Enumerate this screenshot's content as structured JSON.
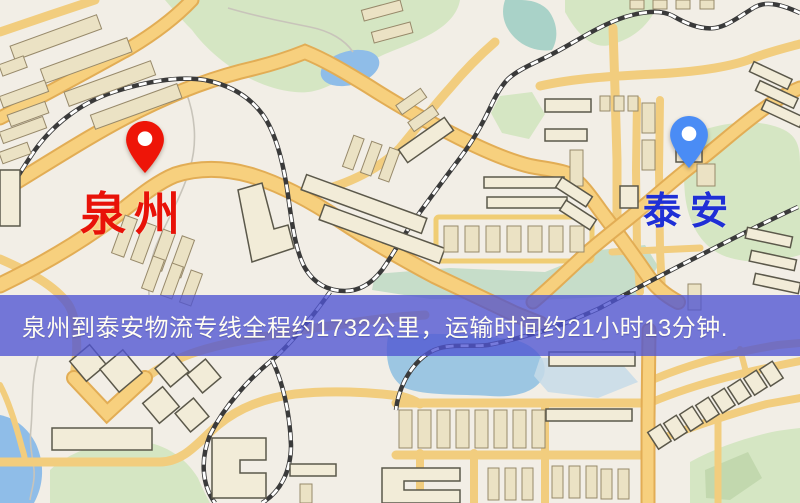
{
  "map": {
    "markers": [
      {
        "id": "origin",
        "label": "泉州",
        "pin_color": "#ee1508",
        "label_color": "#e81208"
      },
      {
        "id": "destination",
        "label": "泰安",
        "pin_color": "#4a8cf5",
        "label_color": "#1f2fd6"
      }
    ],
    "banner": {
      "text": "泉州到泰安物流专线全程约1732公里，运输时间约21小时13分钟.",
      "background": "#5054d2",
      "text_color": "#fffdf2"
    },
    "colors": {
      "land": "#f2eee6",
      "park": "#d5e6c3",
      "water": "#8fbde8",
      "river": "#a9d2c8",
      "road": "#f7d07e",
      "railway": "#3a3a3a",
      "building": "#ebe2c4"
    }
  }
}
